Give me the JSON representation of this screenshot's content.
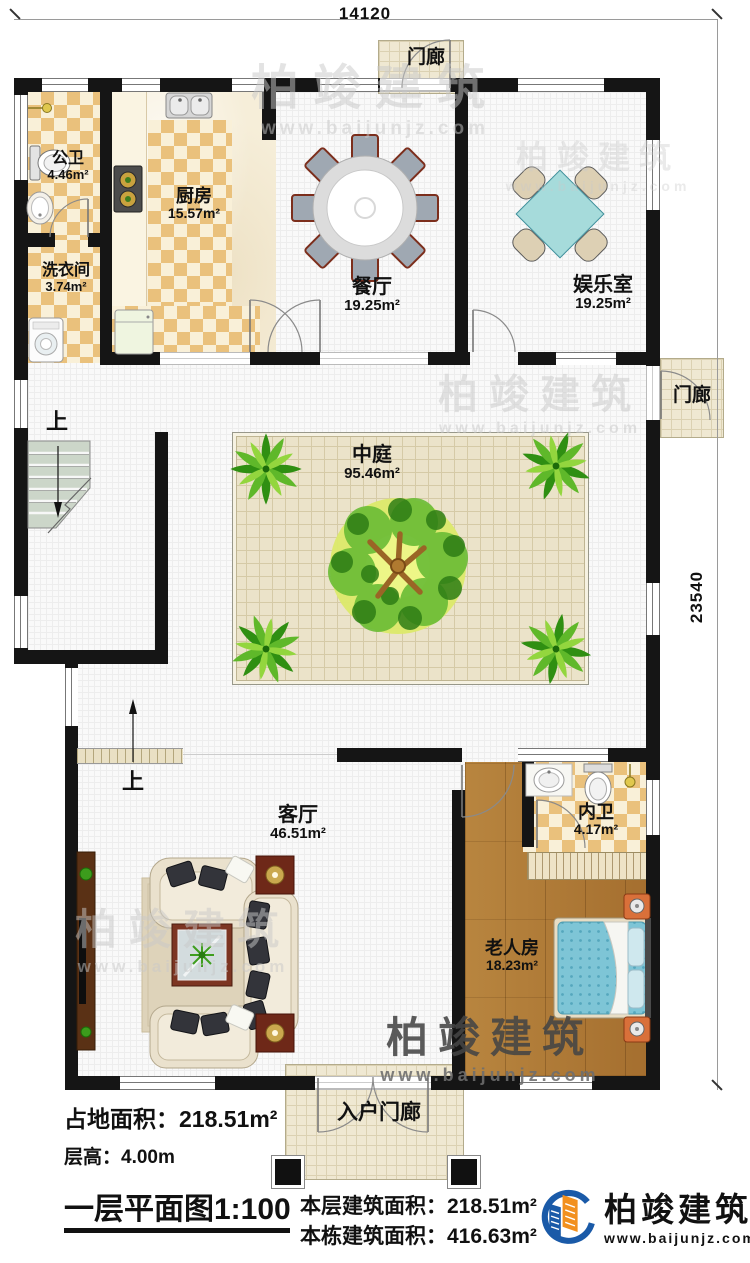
{
  "dimensions": {
    "width": "14120",
    "height": "23540"
  },
  "rooms": [
    {
      "name": "公卫",
      "area": "4.46m²"
    },
    {
      "name": "洗衣间",
      "area": "3.74m²"
    },
    {
      "name": "厨房",
      "area": "15.57m²"
    },
    {
      "name": "餐厅",
      "area": "19.25m²"
    },
    {
      "name": "娱乐室",
      "area": "19.25m²"
    },
    {
      "name": "中庭",
      "area": "95.46m²"
    },
    {
      "name": "客厅",
      "area": "46.51m²"
    },
    {
      "name": "内卫",
      "area": "4.17m²"
    },
    {
      "name": "老人房",
      "area": "18.23m²"
    }
  ],
  "porches": {
    "top": "门廊",
    "right": "门廊",
    "entry": "入户门廊"
  },
  "stairs": {
    "up": "上"
  },
  "info": {
    "footprint_label": "占地面积：",
    "footprint_value": "218.51m²",
    "floor_height_label": "层高：",
    "floor_height_value": "4.00m",
    "plan_title": "一层平面图1:100",
    "floor_area_label": "本层建筑面积：",
    "floor_area_value": "218.51m²",
    "building_area_label": "本栋建筑面积：",
    "building_area_value": "416.63m²"
  },
  "brand": {
    "name": "柏竣建筑",
    "url": "www.baijunjz.com"
  },
  "colors": {
    "brand_blue": "#1a5aa8",
    "brand_orange": "#f2901e",
    "bed_teal": "#7ec5d6",
    "table_teal": "#a6dbdb"
  }
}
